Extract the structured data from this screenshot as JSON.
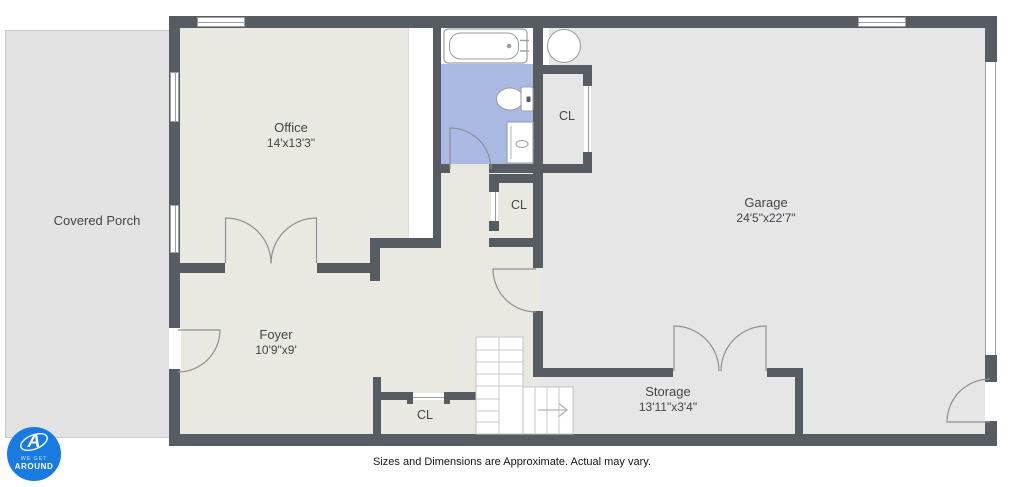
{
  "plan": {
    "disclaimer": "Sizes and Dimensions are Approximate. Actual may vary.",
    "rooms": {
      "covered_porch": {
        "label": "Covered Porch"
      },
      "office": {
        "label": "Office",
        "dims": "14'x13'3\""
      },
      "garage": {
        "label": "Garage",
        "dims": "24'5\"x22'7\""
      },
      "foyer": {
        "label": "Foyer",
        "dims": "10'9\"x9'"
      },
      "storage": {
        "label": "Storage",
        "dims": "13'11\"x3'4\""
      },
      "closet_bath": {
        "label": "CL"
      },
      "closet_hall": {
        "label": "CL"
      },
      "closet_foyer": {
        "label": "CL"
      }
    },
    "icons": {
      "stairs_arrow": "right-arrow",
      "fixtures": [
        "bathtub",
        "toilet",
        "sink-vanity",
        "water-heater"
      ]
    }
  },
  "watermark": {
    "monogram": "A",
    "line1": "WE GET",
    "line2": "AROUND"
  },
  "colors": {
    "wall": "#575c62",
    "floor_interior": "#e9e9e2",
    "floor_garage": "#e6e6e6",
    "floor_porch": "#e3e3e3",
    "floor_bathroom": "#aab9e2",
    "logo_blue": "#177be2"
  }
}
